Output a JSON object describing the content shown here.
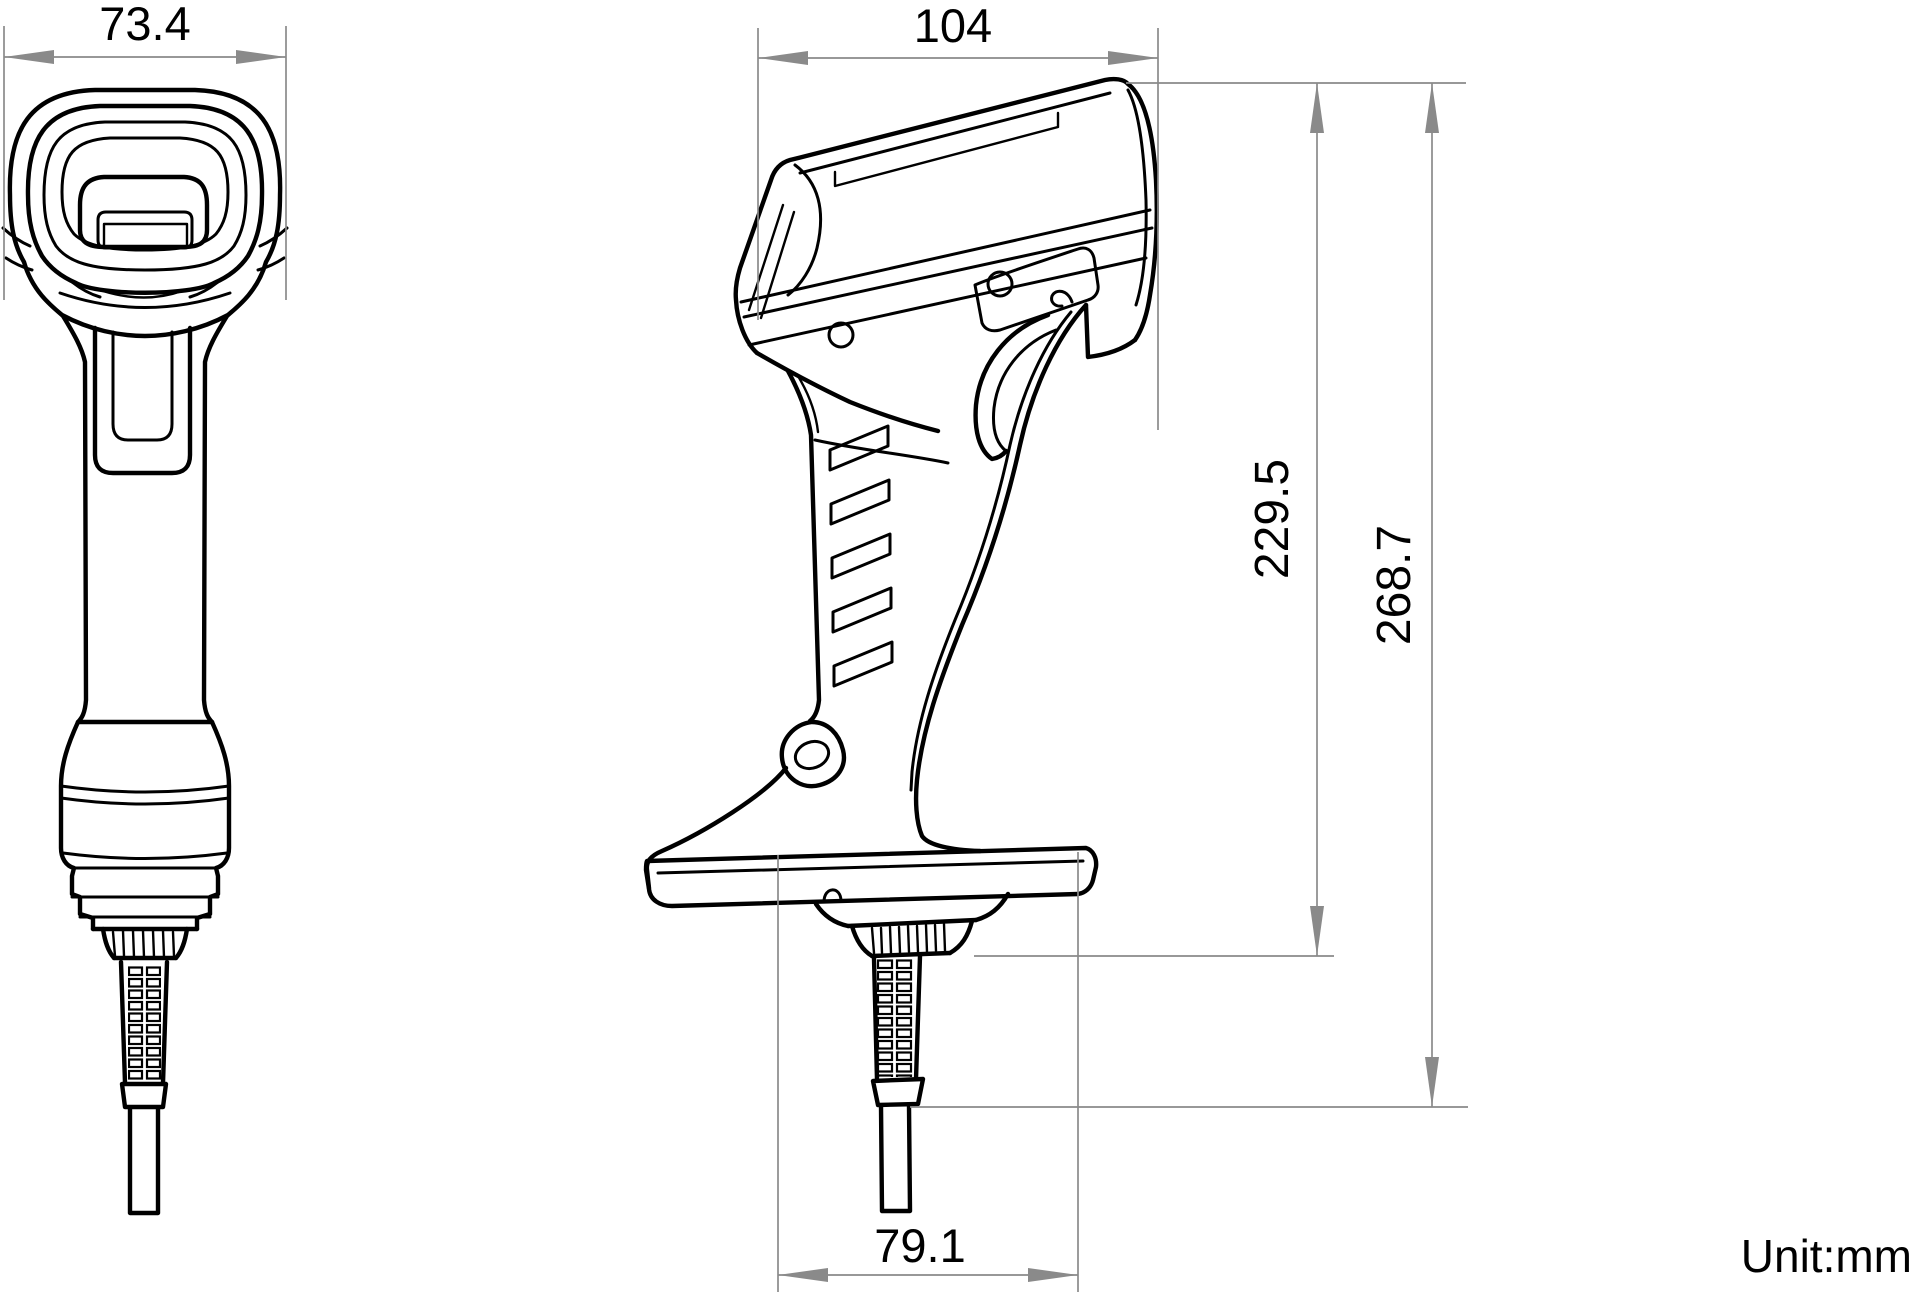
{
  "drawing": {
    "title": "handheld-barcode-scanner-dimension-drawing",
    "unit_label": "Unit:mm",
    "dims": {
      "front_width": "73.4",
      "side_depth": "104",
      "body_height": "229.5",
      "total_height": "268.7",
      "base_width": "79.1"
    }
  },
  "colors": {
    "line": "#000000",
    "dimension": "#8a8a8a",
    "background": "#ffffff"
  }
}
